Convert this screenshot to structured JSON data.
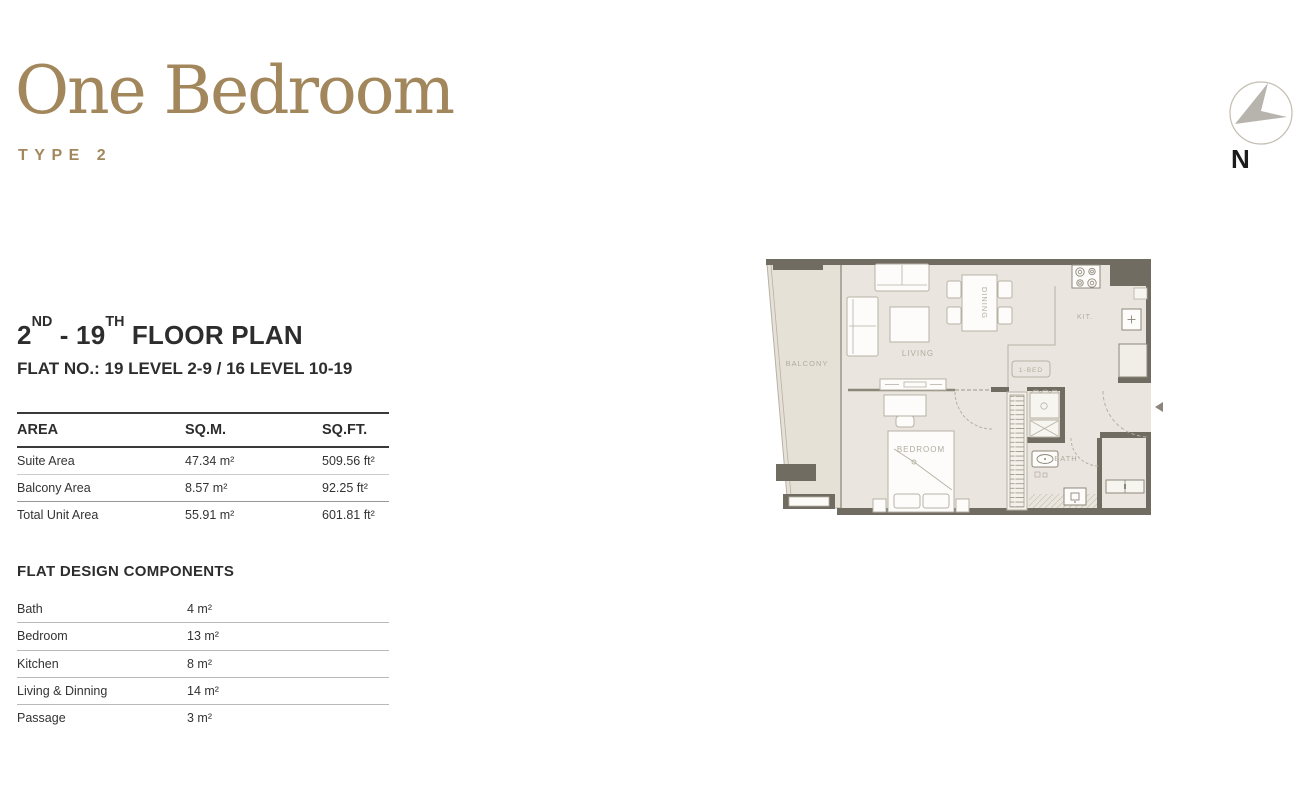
{
  "title": {
    "name": "One Bedroom",
    "type_label": "TYPE 2"
  },
  "north_indicator": {
    "label": "N"
  },
  "plan_header": {
    "parts": {
      "p1": "2",
      "s1": "ND",
      "p2": " - 19",
      "s2": "TH",
      "p3": " FLOOR PLAN"
    },
    "flat_line": "FLAT NO.: 19 LEVEL 2-9 / 16 LEVEL 10-19"
  },
  "area_table": {
    "headers": [
      "AREA",
      "SQ.M.",
      "SQ.FT."
    ],
    "rows": [
      {
        "label": "Suite Area",
        "sqm": "47.34 m²",
        "sqft": "509.56 ft²"
      },
      {
        "label": "Balcony Area",
        "sqm": "8.57 m²",
        "sqft": "92.25 ft²"
      },
      {
        "label": "Total Unit Area",
        "sqm": "55.91 m²",
        "sqft": "601.81 ft²"
      }
    ]
  },
  "components": {
    "heading": "FLAT DESIGN COMPONENTS",
    "rows": [
      {
        "label": "Bath",
        "value": "4 m²"
      },
      {
        "label": "Bedroom",
        "value": "13 m²"
      },
      {
        "label": "Kitchen",
        "value": "8 m²"
      },
      {
        "label": "Living & Dinning",
        "value": "14 m²"
      },
      {
        "label": "Passage",
        "value": "3 m²"
      }
    ]
  },
  "floor_plan": {
    "labels": {
      "balcony": "BALCONY",
      "living": "LIVING",
      "dining": "DINING",
      "kitchen": "KIT.",
      "bedroom": "BEDROOM",
      "bath": "BATH",
      "unit_badge": "1-BED"
    },
    "colors": {
      "accent_gold": "#a3875c",
      "wall": "#716c62",
      "floor": "#eae6df",
      "balcony_floor": "#e6e1d7",
      "outline": "#b7b1a5",
      "room_label": "#b2ac9f",
      "text_dark": "#2d2d2d"
    }
  }
}
